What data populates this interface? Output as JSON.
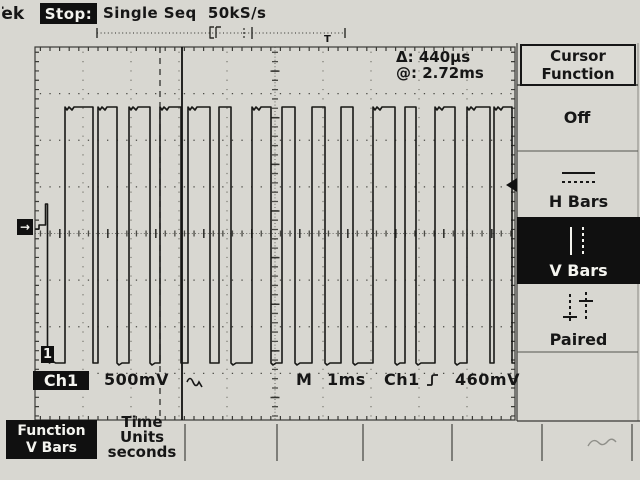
{
  "colors": {
    "screen_bg": "#d8d7d1",
    "ink": "#161616",
    "inverse_bg": "#101010",
    "inverse_fg": "#f4f4ef",
    "grid": "#4a4a45",
    "grid_light": "#77776f",
    "border": "#3a3a36"
  },
  "status_bar": {
    "logo": "Tek",
    "acq_state": "Stop:",
    "acq_mode": "Single Seq",
    "sample_rate": "50kS/s",
    "trigger_marker": "T"
  },
  "cursor_readout": {
    "delta_label": "Δ:",
    "delta_value": "440µs",
    "at_label": "@:",
    "at_value": "2.72ms"
  },
  "sidebar": {
    "title_line1": "Cursor",
    "title_line2": "Function",
    "items": [
      {
        "label": "Off",
        "selected": false,
        "icon": "none"
      },
      {
        "label": "H Bars",
        "selected": false,
        "icon": "h-bars-icon"
      },
      {
        "label": "V Bars",
        "selected": true,
        "icon": "v-bars-icon"
      },
      {
        "label": "Paired",
        "selected": false,
        "icon": "paired-cursors-icon"
      }
    ]
  },
  "channel_readout": {
    "ch_label": "Ch1",
    "scale": "500mV",
    "coupling_icon": "ac-coupling-icon"
  },
  "trigger_readout": {
    "m_label": "M",
    "timebase": "1ms",
    "source": "Ch1",
    "slope_icon": "rising-edge-icon",
    "level": "460mV"
  },
  "bottom_menu": {
    "function_button": {
      "line1": "Function",
      "line2": "V Bars",
      "selected": true
    },
    "time_units_button": {
      "line1": "Time",
      "line2": "Units",
      "line3": "seconds"
    }
  },
  "markers": {
    "ground_marker": "→",
    "channel_marker": "1"
  },
  "waveform": {
    "high_y": 107,
    "low_y": 363,
    "entry_y": 229,
    "spike_x": 45.5,
    "spike_top_y": 204,
    "pulses": [
      [
        65,
        93
      ],
      [
        98,
        117
      ],
      [
        129,
        150
      ],
      [
        160,
        181
      ],
      [
        188,
        210
      ],
      [
        219,
        231
      ],
      [
        252,
        271
      ],
      [
        282,
        295
      ],
      [
        312,
        325
      ],
      [
        341,
        353
      ],
      [
        373,
        395
      ],
      [
        405,
        416
      ],
      [
        435,
        455
      ],
      [
        467,
        490
      ],
      [
        494,
        512
      ]
    ],
    "end_x": 515
  },
  "cursors": {
    "cursor1_x": 160,
    "cursor2_x": 182,
    "ground_y": 227,
    "trigger_level_y": 185,
    "trigger_pos_x": 330
  }
}
